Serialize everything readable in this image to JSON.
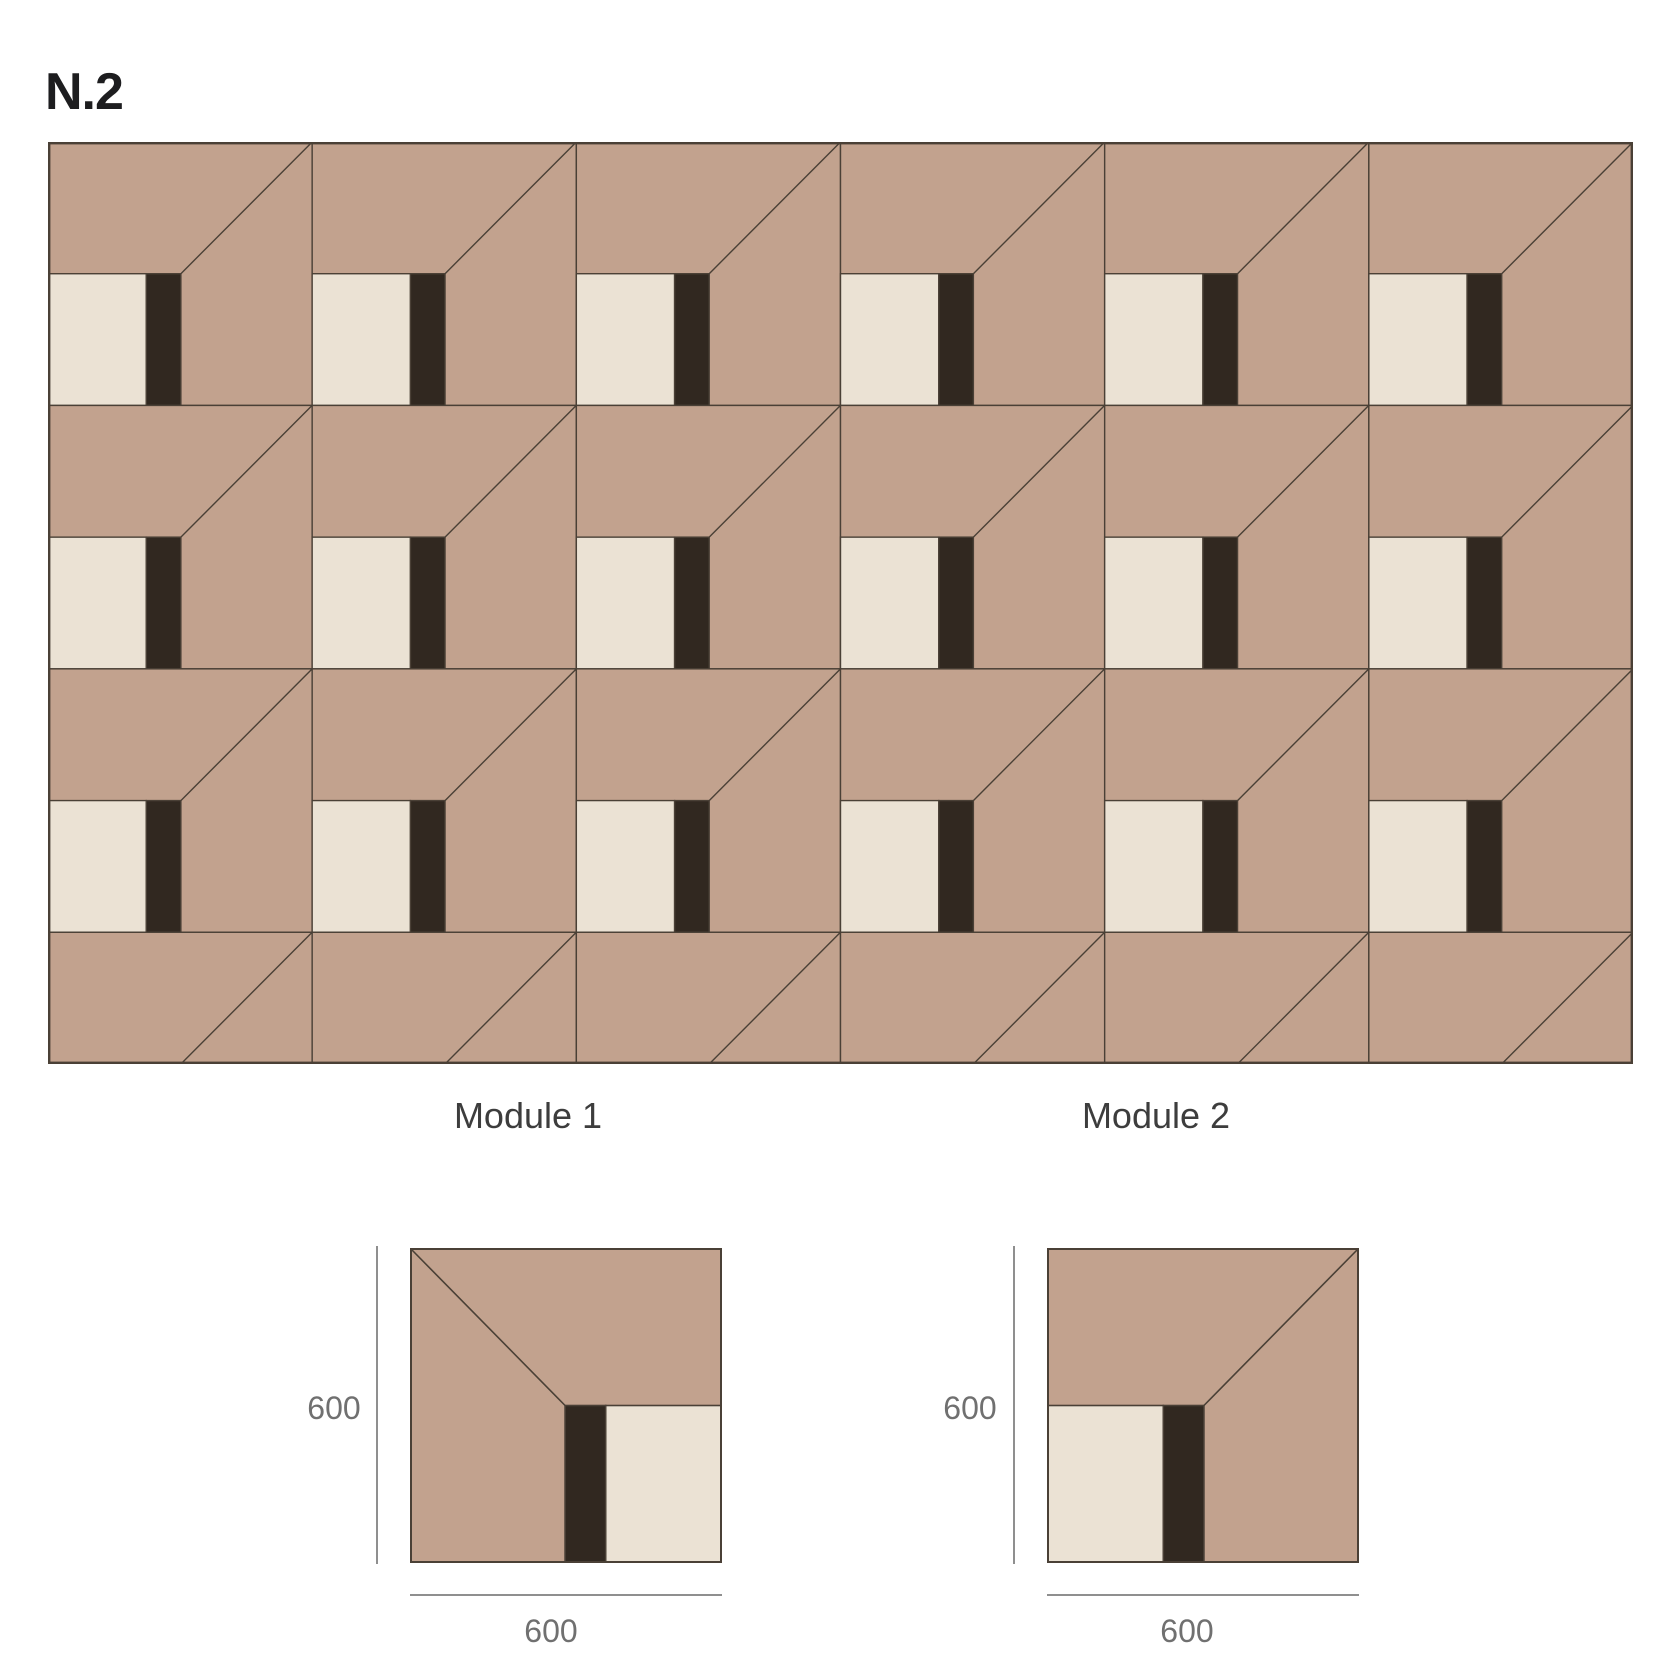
{
  "title": "N.2",
  "colors": {
    "tan": "#c2a28e",
    "cream": "#ebe2d4",
    "dark_stripe": "#312820",
    "outline": "#4a4036",
    "dim_line": "#8f8f8f",
    "dim_text": "#707070",
    "label_text": "#3d3d3d",
    "title_text": "#1d1d1f",
    "background": "#ffffff"
  },
  "grid": {
    "columns": 6,
    "rows_visible": 3.5,
    "tile_orientation": "module-2"
  },
  "modules": [
    {
      "label": "Module 1",
      "mirrored": true,
      "width_mm": "600",
      "height_mm": "600"
    },
    {
      "label": "Module 2",
      "mirrored": false,
      "width_mm": "600",
      "height_mm": "600"
    }
  ]
}
